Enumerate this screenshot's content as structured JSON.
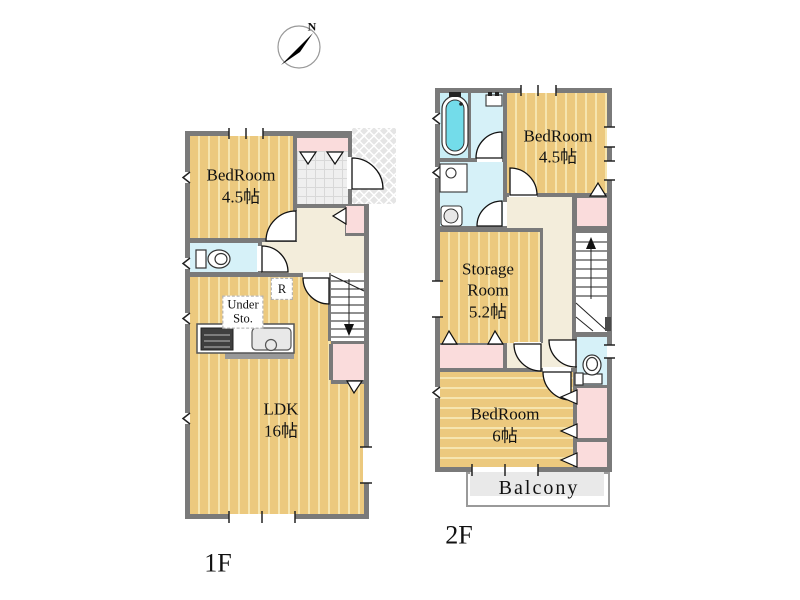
{
  "compass": {
    "north_label": "N"
  },
  "floor1": {
    "label": "1F",
    "rooms": {
      "bedroom": {
        "name": "BedRoom",
        "size": "4.5帖"
      },
      "ldk": {
        "name": "LDK",
        "size": "16帖"
      },
      "under_storage": {
        "line1": "Under",
        "line2": "Sto."
      },
      "refrigerator": {
        "label": "R"
      }
    }
  },
  "floor2": {
    "label": "2F",
    "rooms": {
      "bedroom_small": {
        "name": "BedRoom",
        "size": "4.5帖"
      },
      "storage": {
        "line1": "Storage",
        "line2": "Room",
        "size": "5.2帖"
      },
      "bedroom_large": {
        "name": "BedRoom",
        "size": "6帖"
      },
      "balcony": {
        "name": "Balcony"
      }
    }
  },
  "colors": {
    "wall": "#7a7a7a",
    "wood": "#ecc97e",
    "wood_stripe": "#f6e5af",
    "closet_pink": "#fadcdc",
    "wet_room_cyan": "#d6f1f8",
    "bath_water": "#73dcea",
    "hall_cream": "#f3eddb",
    "entry_tile": "#efefef",
    "porch_lattice": "#e5e5e5",
    "balcony_gray": "#e9e9e9"
  }
}
